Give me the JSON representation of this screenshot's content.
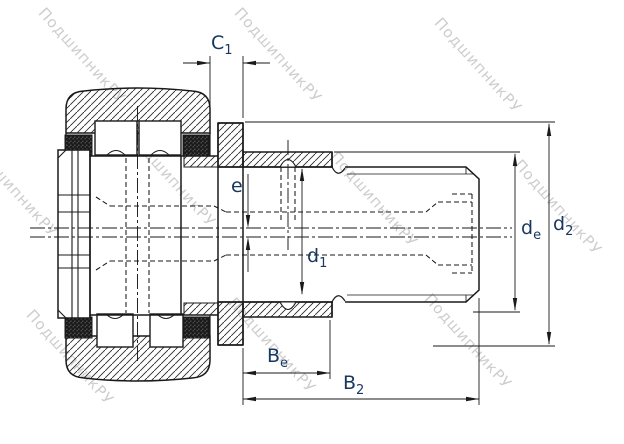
{
  "watermark": {
    "text": "ПодшипникРУ",
    "color": "#c5c5c5"
  },
  "labels": {
    "c1": {
      "base": "C",
      "sub": "1"
    },
    "e": {
      "base": "e",
      "sub": ""
    },
    "d1": {
      "base": "d",
      "sub": "1"
    },
    "de": {
      "base": "d",
      "sub": "e"
    },
    "d2": {
      "base": "d",
      "sub": "2"
    },
    "be": {
      "base": "B",
      "sub": "e"
    },
    "b2": {
      "base": "B",
      "sub": "2"
    }
  },
  "colors": {
    "line": "#1a1a1a",
    "label": "#17375e",
    "watermark": "#c5c5c5",
    "background": "#ffffff"
  }
}
